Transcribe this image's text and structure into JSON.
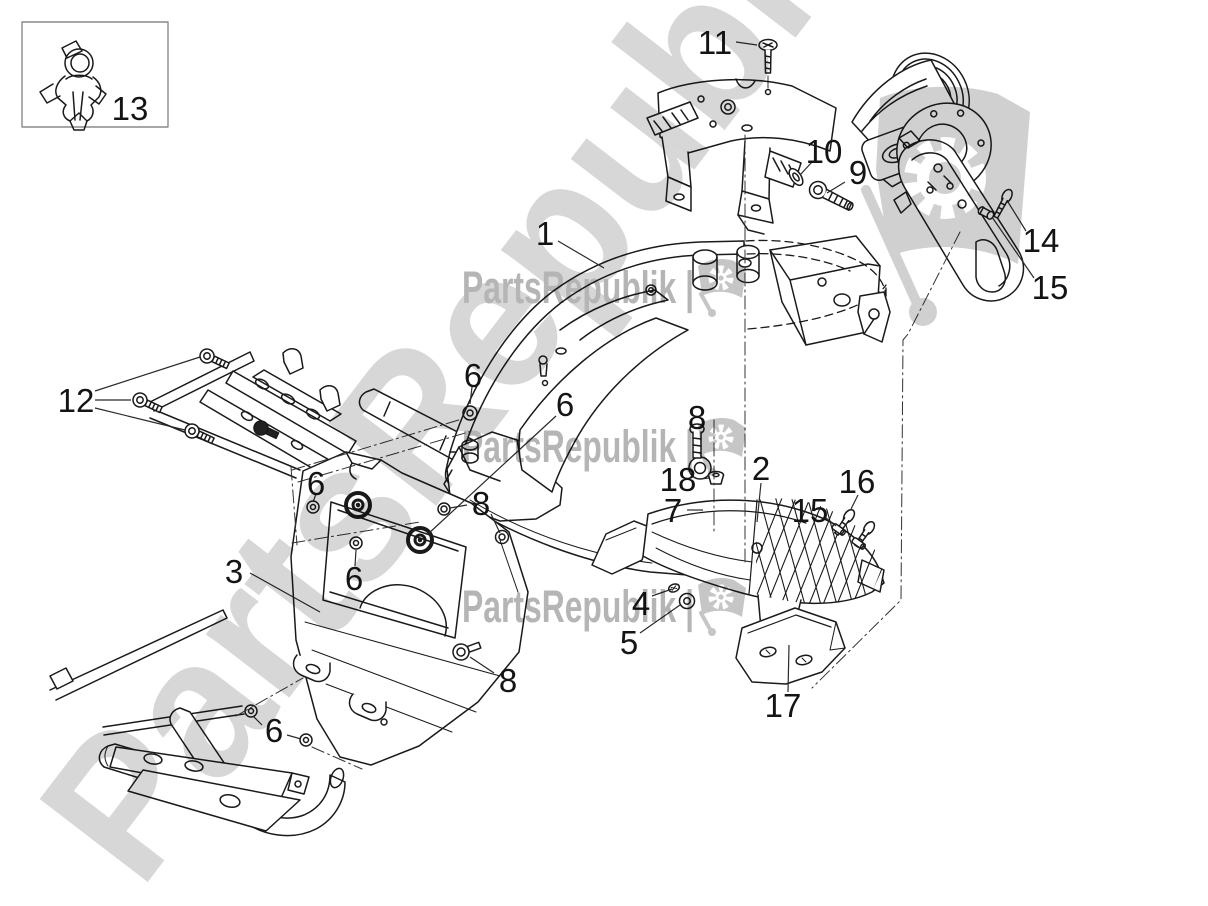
{
  "figure": {
    "kind": "exploded-parts-diagram",
    "background": "#ffffff",
    "line_color": "#1a1a1a"
  },
  "watermark": {
    "row_text": "PartsRepublik |",
    "diagonal_text": "PartsRepublik |",
    "row_color": "#b5b5b5",
    "diagonal_color": "#d7d7d7",
    "flag_color": "#d0d0d0",
    "row_flag_color": "#c6c6c6"
  },
  "callouts": [
    {
      "label": "1",
      "x": 545,
      "y": 233,
      "leaders": [
        [
          558,
          241,
          604,
          268
        ]
      ]
    },
    {
      "label": "2",
      "x": 761,
      "y": 468,
      "leaders": [
        [
          761,
          483,
          757,
          522
        ]
      ]
    },
    {
      "label": "3",
      "x": 234,
      "y": 571,
      "leaders": [
        [
          250,
          573,
          320,
          612
        ]
      ]
    },
    {
      "label": "4",
      "x": 641,
      "y": 603,
      "leaders": [
        [
          652,
          596,
          672,
          589
        ]
      ]
    },
    {
      "label": "5",
      "x": 629,
      "y": 642,
      "leaders": [
        [
          640,
          633,
          680,
          605
        ]
      ]
    },
    {
      "label": "6",
      "x": 316,
      "y": 483,
      "leaders": [
        [
          316,
          494,
          313,
          502
        ]
      ]
    },
    {
      "label": "6",
      "x": 354,
      "y": 578,
      "leaders": [
        [
          355,
          566,
          356,
          550
        ]
      ]
    },
    {
      "label": "6",
      "x": 473,
      "y": 375,
      "leaders": [
        [
          472,
          387,
          470,
          404
        ]
      ]
    },
    {
      "label": "6",
      "x": 565,
      "y": 404,
      "leaders": [
        [
          556,
          416,
          428,
          534
        ]
      ]
    },
    {
      "label": "6",
      "x": 274,
      "y": 730,
      "leaders": [
        [
          262,
          725,
          253,
          716
        ],
        [
          287,
          735,
          301,
          739
        ]
      ]
    },
    {
      "label": "7",
      "x": 673,
      "y": 510,
      "leaders": [
        [
          687,
          510,
          703,
          510
        ]
      ]
    },
    {
      "label": "8",
      "x": 481,
      "y": 503,
      "leaders": [
        [
          467,
          505,
          450,
          508
        ],
        [
          491,
          514,
          500,
          533
        ]
      ]
    },
    {
      "label": "8",
      "x": 508,
      "y": 680,
      "leaders": [
        [
          494,
          673,
          470,
          657
        ]
      ]
    },
    {
      "label": "8",
      "x": 697,
      "y": 417,
      "leaders": []
    },
    {
      "label": "9",
      "x": 858,
      "y": 172,
      "leaders": [
        [
          845,
          182,
          827,
          193
        ]
      ]
    },
    {
      "label": "10",
      "x": 824,
      "y": 151,
      "leaders": [
        [
          812,
          162,
          800,
          175
        ]
      ]
    },
    {
      "label": "11",
      "x": 715,
      "y": 42,
      "leaders": [
        [
          736,
          42,
          757,
          45
        ]
      ]
    },
    {
      "label": "12",
      "x": 76,
      "y": 400,
      "leaders": [
        [
          95,
          391,
          200,
          357
        ],
        [
          95,
          400,
          131,
          400
        ],
        [
          95,
          408,
          185,
          430
        ]
      ]
    },
    {
      "label": "13",
      "x": 130,
      "y": 108,
      "leaders": []
    },
    {
      "label": "14",
      "x": 1041,
      "y": 240,
      "leaders": [
        [
          1026,
          231,
          1008,
          202
        ]
      ]
    },
    {
      "label": "15",
      "x": 1050,
      "y": 287,
      "leaders": [
        [
          1034,
          278,
          992,
          217
        ]
      ]
    },
    {
      "label": "15",
      "x": 810,
      "y": 510,
      "leaders": [
        [
          826,
          518,
          836,
          526
        ]
      ]
    },
    {
      "label": "16",
      "x": 857,
      "y": 481,
      "leaders": [
        [
          858,
          495,
          851,
          509
        ]
      ]
    },
    {
      "label": "17",
      "x": 783,
      "y": 705,
      "leaders": [
        [
          788,
          692,
          789,
          645
        ]
      ]
    },
    {
      "label": "18",
      "x": 678,
      "y": 479,
      "leaders": [
        [
          700,
          479,
          709,
          478
        ]
      ]
    }
  ]
}
